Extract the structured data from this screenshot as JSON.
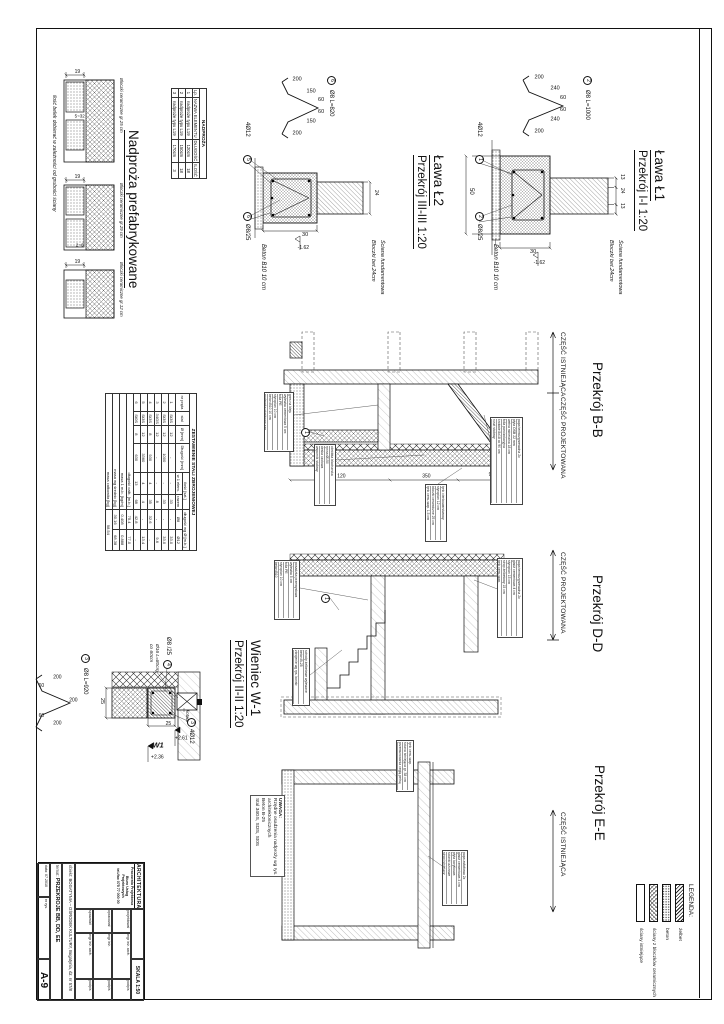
{
  "titles": {
    "l1_name": "Ława Ł1",
    "l1_sec": "Przekrój I-I 1:20",
    "l2_name": "Ława Ł2",
    "l2_sec": "Przekrój III-III 1:20",
    "nadproza": "Nadproża prefabrykowane",
    "w1_name": "Wieniec W-1",
    "w1_sec": "Przekrój II-II 1:20",
    "bb": "Przekrój B-B",
    "dd": "Przekrój D-D",
    "ee": "Przekrój E-E"
  },
  "part_labels": {
    "existing": "CZĘŚĆ ISTNIEJĄCA",
    "designed": "CZĘŚĆ PROJEKTOWANA"
  },
  "l1": {
    "bar_mark": "2",
    "bar": "Ø8 L=1000",
    "d200a": "200",
    "d240a": "240",
    "d240b": "240",
    "d60a": "60",
    "d60b": "60",
    "d200b": "200",
    "rebar_mark": "1",
    "rebar": "4Ø12",
    "st_mark": "2",
    "stirrup": "Ø8/25",
    "lean": "Beton B10 10 cm",
    "wall1": "Ściana fundamentowa",
    "wall2": "Bloczki bet.24cm",
    "dw1": "13",
    "dw2": "24",
    "dw3": "13",
    "dwidth": "50",
    "dh": "30",
    "level": "-1.62"
  },
  "l2": {
    "bar_mark": "6",
    "bar": "Ø8 L=820",
    "d200a": "200",
    "d150a": "150",
    "d150b": "150",
    "d60a": "60",
    "d60b": "60",
    "d200b": "200",
    "rebar_mark": "5",
    "rebar": "4Ø12",
    "st_mark": "6",
    "stirrup": "Ø8/25",
    "lean": "Beton B10 10 cm",
    "wall1": "Ściana fundamentowa",
    "wall2": "Bloczki bet.24cm",
    "dtop": "24",
    "dh": "30",
    "level": "-1.62"
  },
  "w1": {
    "bar_mark": "3",
    "bar": "Ø8 L=920",
    "d200a": "200",
    "d200b": "200",
    "d200c": "200",
    "d60a": "60",
    "d60b": "60",
    "st_mark": "4",
    "stirrup": "Ø8 /25",
    "rebar_mark": "3",
    "rebar": "4Ø12",
    "anchor1": "Ø16 L=80cm",
    "anchor2": "co 60cm",
    "kotwa": "kotwa",
    "lvl_top": "+2.61",
    "wmark": "W1",
    "lvl_bot": "+2.36",
    "d25a": "25",
    "d25b": "25"
  },
  "nadproza_table": {
    "title": "NADPROŻA",
    "cols": [
      "Lp.",
      "NAZWA ELEMENTU",
      "DŁUGOŚĆ",
      "ILOŚĆ"
    ],
    "rows": [
      [
        "1",
        "nadproże typu L19",
        "120cm",
        "18"
      ],
      [
        "2",
        "nadproże typu L19",
        "150cm",
        "18"
      ],
      [
        "3",
        "nadproże typu L19",
        "170cm",
        "3"
      ]
    ]
  },
  "lintels": {
    "d19": "19",
    "gap1": "5~32",
    "gap3": "2~6",
    "labels": [
      "Bloczki ceramiczne gr.25 cm",
      "Bloczki ceramiczne gr.29 cm",
      "Bloczki ceramiczne gr.12 cm"
    ],
    "note": "ilość belek dobierać w zależności od grubości ściany"
  },
  "steel_table": {
    "title": "ZESTAWIENIE STALI ZBROJENIOWEJ",
    "h_nr": "nr pręta",
    "h_stal": "stal",
    "h_fi": "Ø [mm]",
    "h_len": "Długość [mm]",
    "h_qty": "ilość [szt.]",
    "h_q1": "w 1 elem.",
    "h_q2": "razem",
    "h_lw": "długość wg Ø [m.b.]",
    "h_f8": "Ø8",
    "h_f12": "Ø12",
    "rows": [
      [
        "1",
        "St3S",
        "12",
        "-",
        "-",
        "33",
        "-",
        "33.0"
      ],
      [
        "2",
        "St3S",
        "12",
        "1000",
        "-",
        "33",
        "-",
        "33.0"
      ],
      [
        "3",
        "34GS",
        "12",
        "-",
        "-",
        "8",
        "-",
        "9.6"
      ],
      [
        "4",
        "St3S",
        "8",
        "930",
        "4",
        "35",
        "32.6",
        "-"
      ],
      [
        "5",
        "St3S",
        "12",
        "3360",
        "4",
        "4",
        "-",
        "13.4"
      ],
      [
        "6",
        "St0S",
        "8",
        "630",
        "13",
        "68",
        "42.8",
        "-"
      ]
    ],
    "sum": [
      [
        "długość całk. [m.b.]",
        "75.4",
        "77.0"
      ],
      [
        "masa 1 m.b. [kg/m]",
        "0.408",
        "0.888"
      ],
      [
        "masa wg średnic [kg]",
        "30.16",
        "68.38"
      ]
    ],
    "total_label": "masa całkowita [kg]",
    "total": "98.54"
  },
  "uwaga": {
    "line1": "UWAGA:",
    "line2": "Rzędne osadzenia nadproży wg rys.",
    "line3": "architektonicznych",
    "line4": "Beton B-25",
    "line5": "Stal 34GS, St3S, St0S"
  },
  "bb": {
    "mark": "1",
    "dim1": "90",
    "dim2": "350",
    "dim3": "120",
    "blocks": {
      "roof": [
        "papa termozgrzewalna 2x",
        "płyta OSB 22 mm",
        "wełna mineralna 18 cm",
        "folia paroizolacyjna",
        "krokwie 8x18 co 90 cm",
        "ruszt stalowy",
        "płyta g-k 12.5 mm"
      ],
      "beam": [
        "obróbka blacharska",
        "rynna Ø150",
        "deska czołowa",
        "wspornik stalowy"
      ],
      "wall": [
        "tynk cienkowarstwowy",
        "styropian 12 cm",
        "bloczki ceramiczne 25 cm",
        "tynk cem.-wap. 1.5 cm"
      ],
      "floor": [
        "gres na kleju",
        "wylewka cementowa 5 cm",
        "folia PE",
        "styropian 10 cm",
        "beton B10 10 cm",
        "podsypka piaskowa zag."
      ]
    }
  },
  "dd": {
    "mark": "1",
    "blocks": {
      "roof": [
        "papa termozgrzewalna 2x",
        "gładź cementowa 4 cm",
        "styropian 15 cm",
        "strop żelbetowy 15 cm",
        "tynk cem.-wap."
      ],
      "floor": [
        "posadzka przemysłowa",
        "wylewka 5 cm",
        "folia PE",
        "styropian 10 cm",
        "beton B10"
      ],
      "stairs": [
        "schody żelbetowe wylewane",
        "beton B-25",
        "zbrojenie wg rys. konstr."
      ]
    }
  },
  "ee": {
    "blocks": {
      "wall": [
        "tynk cem.-wap.",
        "ściana istniejąca gr. 38 cm",
        "przemurowania cegłą pełną"
      ],
      "ceiling": [
        "papa asfaltowa 2x",
        "gładź cementowa 3 cm",
        "płyta korytkowa",
        "ścianki ażurowe",
        "strop istniejący"
      ]
    }
  },
  "legend": {
    "title": "LEGENDA:",
    "items": [
      "żelbet",
      "beton",
      "ściany z bloczków ceramicznych",
      "ściany istniejące"
    ]
  },
  "titleblock": {
    "logo": [
      "ARCHITEKTURA",
      "Pracownia Projektowa",
      "Biuro Usług Projektowych",
      "tel./fax 075 77 000 00"
    ],
    "skala": "SKALA 1:50",
    "obiekt_label": "obiekt:",
    "obiekt": "BOGATYNIA – OŚRODEK KULTURY, Bogatynia, dz. nr 57/8",
    "temat_label": "temat:",
    "temat": "PRZEKROJE BB, DD, EE",
    "data_label": "data:",
    "data": "07.2010",
    "nr_label": "nr rys.",
    "nr": "A-9",
    "roles": [
      [
        "projektował",
        "mgr inż. arch.",
        "podpis"
      ],
      [
        "opracował",
        "mgr inż.",
        "podpis"
      ],
      [
        "sprawdził",
        "mgr inż. arch.",
        "podpis"
      ]
    ]
  }
}
